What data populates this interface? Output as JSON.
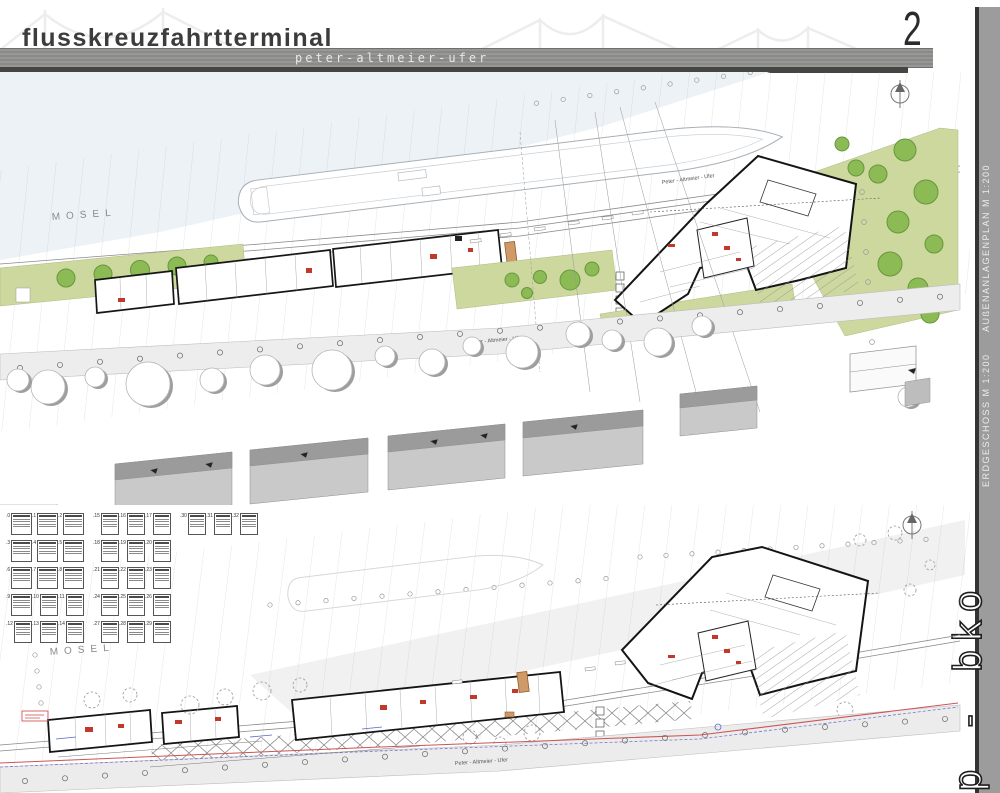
{
  "header": {
    "title": "flusskreuzfahrtterminal",
    "subtitle": "peter-altmeier-ufer",
    "page_number": "2"
  },
  "sidebar": {
    "site_plan_label": "AUßENANLAGENPLAN M 1:200",
    "ground_floor_label": "ERDGESCHOSS M 1:200",
    "signature": "p - bko"
  },
  "plan_top": {
    "name": "Aussenanlagenplan (site plan)",
    "river_label": "MOSEL",
    "street_label_quay": "Peter - Altmeier - Ufer",
    "street_label_road": "Peter - Altmeier - Ufer"
  },
  "plan_bottom": {
    "name": "Erdgeschoss (ground floor plan)",
    "river_label": "MOSEL",
    "street_label_road": "Peter - Altmeier - Ufer"
  },
  "room_schedule": {
    "rows": [
      {
        "cells": [
          ".0",
          ".1",
          ".2",
          ".15",
          ".16",
          ".17",
          ".30",
          ".31",
          ".32"
        ]
      },
      {
        "cells": [
          ".3",
          ".4",
          ".5",
          ".18",
          ".19",
          ".20"
        ]
      },
      {
        "cells": [
          ".6",
          ".7",
          ".8",
          ".21",
          ".22",
          ".23"
        ]
      },
      {
        "cells": [
          ".9",
          ".10",
          ".11",
          ".24",
          ".25",
          ".26"
        ]
      },
      {
        "cells": [
          ".12",
          ".13",
          ".14",
          ".27",
          ".28",
          ".29"
        ]
      }
    ]
  },
  "colors": {
    "lawn_green": "#cdd89f",
    "tree_green": "#8cbb56",
    "annotation_red": "#c0392b",
    "annotation_blue": "#5566cc",
    "bar_gray": "#8f8f8d",
    "sidebar_gray": "#9c9c9c",
    "building_gray": "#c9c9c9",
    "water_tint": "#edf2f7"
  }
}
